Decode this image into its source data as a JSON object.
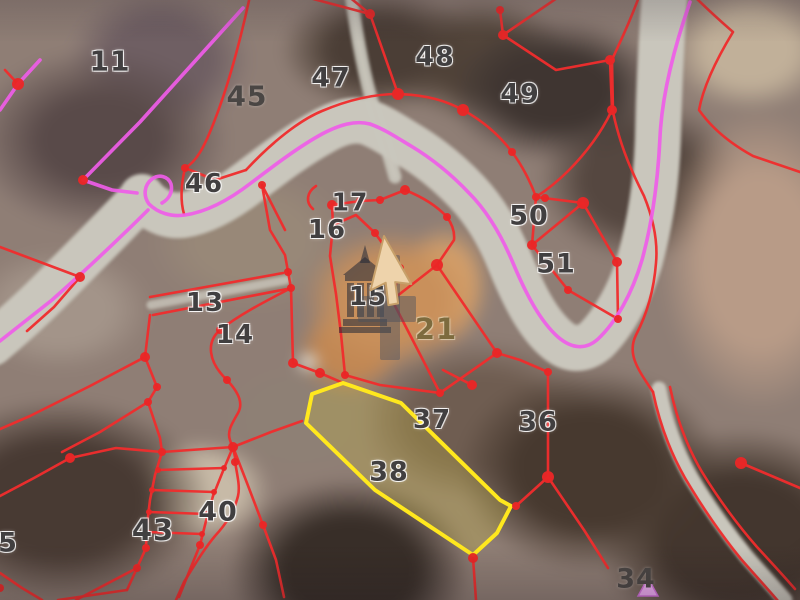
{
  "map": {
    "type": "cadastral-parcel-viewer-over-aerial-imagery",
    "colors": {
      "parcel_boundary": "#ef2d2d",
      "vertex_dot": "#ea2727",
      "route_line": "#ef5ce8",
      "selected_outline": "#ffe81e",
      "cursor_fill": "#eed3ab"
    },
    "selected_parcel": "38",
    "cursor": {
      "x": 384,
      "y": 236,
      "rotation": 14
    },
    "markers": {
      "monument": {
        "parcel": "15"
      },
      "waypoint_triangle": {
        "x": 648,
        "y": 590
      }
    },
    "parcels": [
      {
        "label": "11",
        "x": 110,
        "y": 61,
        "variant": "outlined",
        "size": 28
      },
      {
        "label": "45",
        "x": 247,
        "y": 96,
        "variant": "plain",
        "size": 28
      },
      {
        "label": "47",
        "x": 331,
        "y": 78,
        "variant": "outlined",
        "size": 27
      },
      {
        "label": "48",
        "x": 435,
        "y": 57,
        "variant": "outlined",
        "size": 27
      },
      {
        "label": "49",
        "x": 520,
        "y": 94,
        "variant": "outlined",
        "size": 27
      },
      {
        "label": "46",
        "x": 204,
        "y": 184,
        "variant": "outlined",
        "size": 26
      },
      {
        "label": "17",
        "x": 350,
        "y": 202,
        "variant": "outlined",
        "size": 25
      },
      {
        "label": "16",
        "x": 327,
        "y": 230,
        "variant": "outlined",
        "size": 26
      },
      {
        "label": "50",
        "x": 529,
        "y": 216,
        "variant": "outlined",
        "size": 27
      },
      {
        "label": "51",
        "x": 556,
        "y": 264,
        "variant": "outlined",
        "size": 27
      },
      {
        "label": "13",
        "x": 205,
        "y": 303,
        "variant": "outlined",
        "size": 26
      },
      {
        "label": "14",
        "x": 235,
        "y": 335,
        "variant": "outlined",
        "size": 26
      },
      {
        "label": "15",
        "x": 368,
        "y": 297,
        "variant": "outlined",
        "size": 26
      },
      {
        "label": "21",
        "x": 436,
        "y": 329,
        "variant": "olive",
        "size": 29
      },
      {
        "label": "37",
        "x": 432,
        "y": 420,
        "variant": "outlined",
        "size": 26
      },
      {
        "label": "36",
        "x": 538,
        "y": 422,
        "variant": "outlined",
        "size": 27
      },
      {
        "label": "38",
        "x": 389,
        "y": 472,
        "variant": "outlined",
        "size": 27
      },
      {
        "label": "40",
        "x": 218,
        "y": 512,
        "variant": "outlined",
        "size": 27
      },
      {
        "label": "43",
        "x": 153,
        "y": 530,
        "variant": "outlined",
        "size": 29
      },
      {
        "label": "34",
        "x": 636,
        "y": 579,
        "variant": "plain",
        "size": 27
      },
      {
        "label": "5",
        "x": 8,
        "y": 543,
        "variant": "outlined",
        "size": 27
      }
    ]
  }
}
